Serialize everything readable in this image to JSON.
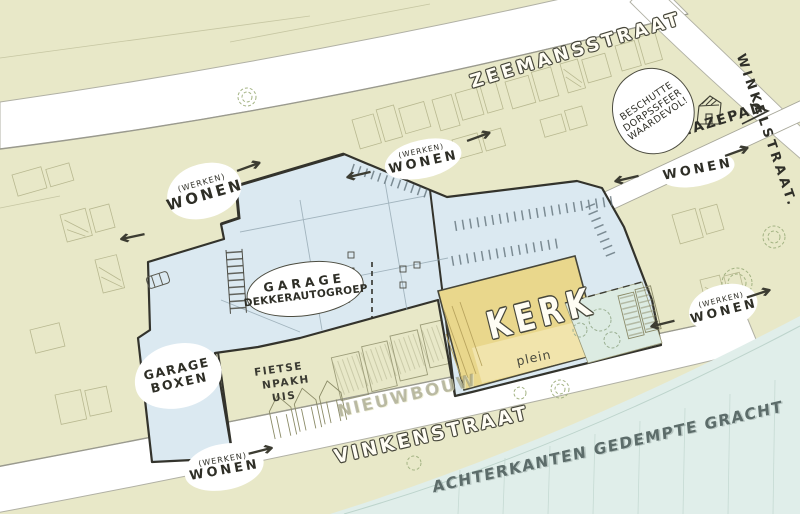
{
  "colors": {
    "background": "#e8e8c8",
    "street": "#ffffff",
    "site_blue": "#dbe9f1",
    "kerk_yellow": "#e9d78c",
    "plein_yellow": "#f1e5ae",
    "garden_green": "#dcebe2",
    "water_blue": "#e0eeea",
    "ink": "#3c3c32",
    "sketch": "#b3b38a"
  },
  "streets": {
    "zeemansstraat": "ZEEMANSSTRAAT",
    "winkelstraat": "WINKELSTRAAT.",
    "hazepad": "HAZEPAD",
    "vinkenstraat": "VINKENSTRAAT"
  },
  "waterfront": {
    "label": "ACHTERKANTEN GEDEMPTE GRACHT"
  },
  "site": {
    "garage": {
      "line1": "GARAGE",
      "line2": "DEKKERAUTOGROEP"
    },
    "garage_boxen": {
      "line1": "GARAGE",
      "line2": "BOXEN"
    },
    "kerk": "KERK",
    "plein": "plein",
    "fietsenpakhuis": {
      "line1": "FIETSE",
      "line2": "NPAKH",
      "line3": "UIS"
    },
    "nieuwbouw": "NIEUWBOUW"
  },
  "zones": {
    "top_left": {
      "sub": "(WERKEN)",
      "main": "WONEN"
    },
    "top_mid": {
      "sub": "(WERKEN)",
      "main": "WONEN"
    },
    "top_right": {
      "main": "WONEN"
    },
    "right": {
      "sub": "(WERKEN)",
      "main": "WONEN"
    },
    "bottom": {
      "sub": "(WERKEN)",
      "main": "WONEN"
    }
  },
  "callout": {
    "line1": "BESCHUTTE",
    "line2": "DORPSSFEER",
    "line3": "WAARDEVOL!"
  },
  "icons": {
    "arrow_right": "→",
    "arrow_left": "←"
  }
}
